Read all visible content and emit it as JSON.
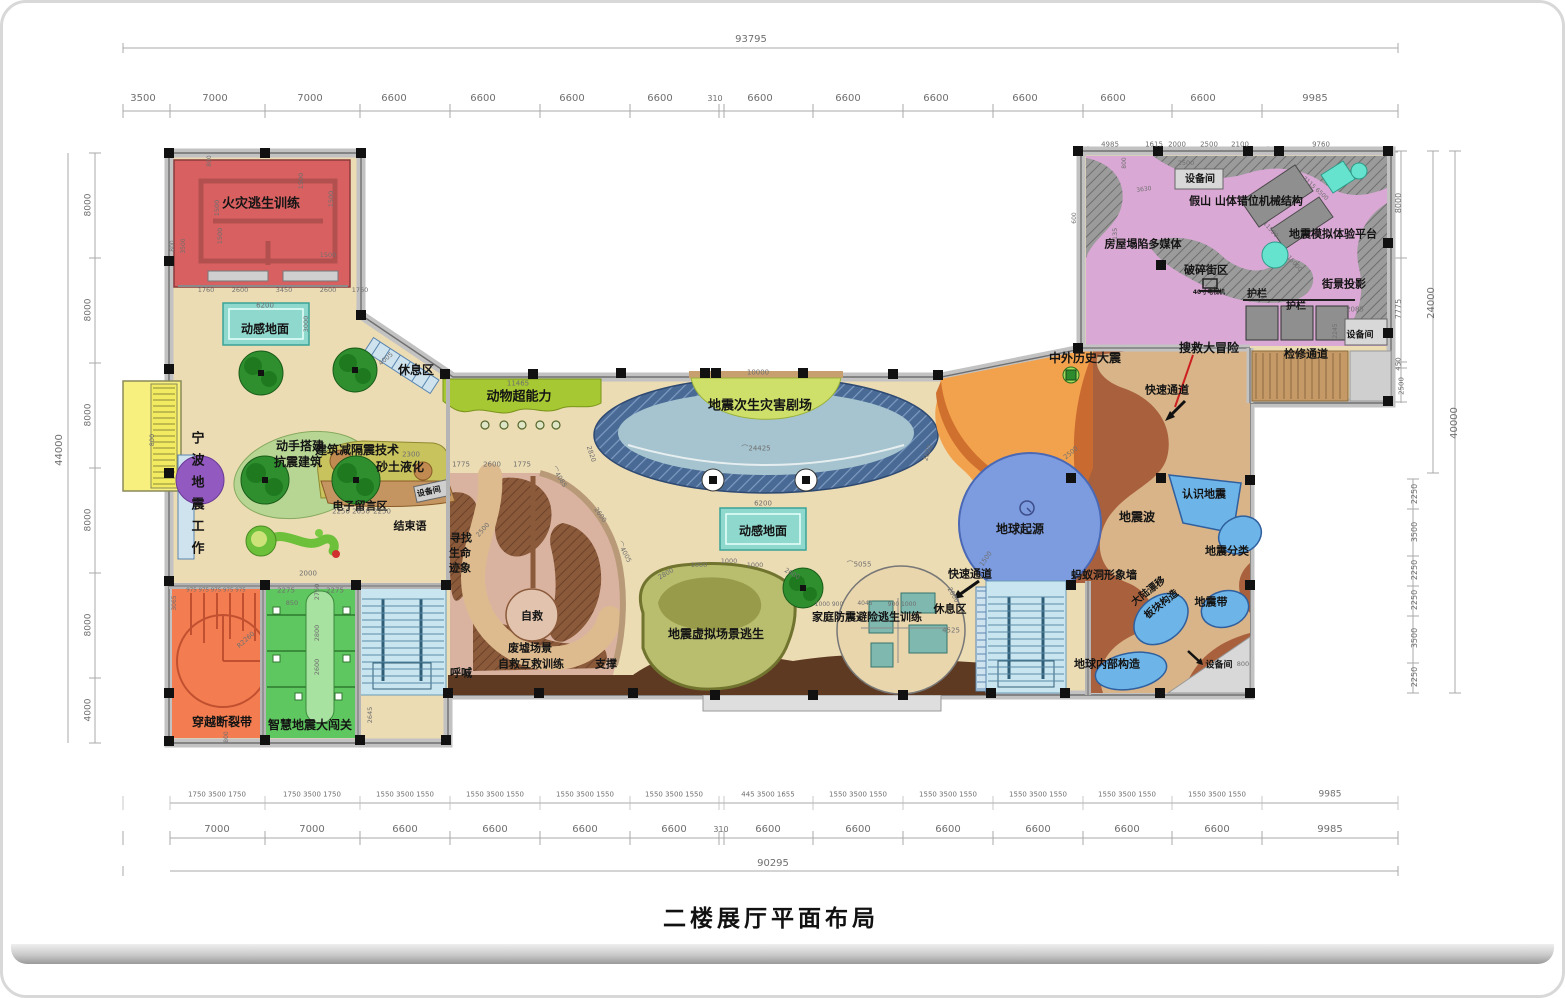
{
  "title": "二楼展厅平面布局",
  "palette": {
    "floor": "#ecdcb4",
    "wall": "#c2c2c2",
    "fire_room": "#d96060",
    "mat_teal": "#8fd8ce",
    "animal_band": "#a6c832",
    "theater_navy": "#4a6a96",
    "theater_inner": "#a5c4cf",
    "stage": "#cfe06a",
    "orange": "#f2a24d",
    "orange_dark": "#d0702e",
    "brown": "#a9603c",
    "path_tan": "#d8b488",
    "pink": "#d9a8d4",
    "rockery": "#9b9b9b",
    "cyan_slide": "#66e3cf",
    "earth_blue": "#7d9ce0",
    "stairs_blue": "#c9e6f0",
    "ruins_dark": "#8a5a3a",
    "ruins_light": "#d9b3a0",
    "olive": "#b9bd6e",
    "family_tan": "#e9d6ad",
    "room_orange": "#f37c50",
    "room_green": "#5fc75f",
    "yellow": "#f7f07e",
    "purple": "#9259c0",
    "tree_green": "#2f8f2f",
    "teal_room": "#7fb8af",
    "blue_blob": "#6db5e8",
    "dark_band": "#5f3a22",
    "dim_text": "#6f6f6f"
  },
  "zones": [
    {
      "t": "火灾逃生训练",
      "x": 258,
      "y": 201,
      "s": 13,
      "n": "zone-fire-escape-training"
    },
    {
      "t": "动感地面",
      "x": 262,
      "y": 326,
      "s": 12,
      "n": "zone-dynamic-floor-1"
    },
    {
      "t": "休息区",
      "x": 413,
      "y": 367,
      "s": 12,
      "n": "zone-rest-area-1"
    },
    {
      "t": "动物超能力",
      "x": 516,
      "y": 394,
      "s": 13,
      "n": "zone-animal-superpower"
    },
    {
      "t": "宁波地震工作",
      "x": 193,
      "y": 494,
      "s": 13,
      "v": 1,
      "n": "zone-ningbo-seismic-work"
    },
    {
      "t": "动手搭建",
      "x": 297,
      "y": 443,
      "s": 12,
      "n": "zone-build-quake-resistant-1"
    },
    {
      "t": "抗震建筑",
      "x": 295,
      "y": 459,
      "s": 12,
      "n": "zone-build-quake-resistant-2"
    },
    {
      "t": "建筑减隔震技术",
      "x": 354,
      "y": 447,
      "s": 12,
      "n": "zone-seismic-isolation-tech"
    },
    {
      "t": "砂土液化",
      "x": 397,
      "y": 464,
      "s": 12,
      "n": "zone-sand-liquefaction"
    },
    {
      "t": "电子留言区",
      "x": 357,
      "y": 503,
      "s": 11,
      "n": "zone-e-message-area"
    },
    {
      "t": "设备间",
      "x": 426,
      "y": 489,
      "s": 8,
      "r": -12,
      "n": "zone-equipment-room-1"
    },
    {
      "t": "结束语",
      "x": 407,
      "y": 523,
      "s": 11,
      "n": "zone-epilogue"
    },
    {
      "t": "地震次生灾害剧场",
      "x": 757,
      "y": 403,
      "s": 13,
      "n": "zone-secondary-disaster-theater"
    },
    {
      "t": "动感地面",
      "x": 760,
      "y": 528,
      "s": 12,
      "n": "zone-dynamic-floor-2"
    },
    {
      "t": "中外历史大震",
      "x": 1082,
      "y": 355,
      "s": 12,
      "n": "zone-historic-earthquakes"
    },
    {
      "t": "搜救大冒险",
      "x": 1206,
      "y": 345,
      "s": 12,
      "n": "zone-search-rescue-adventure"
    },
    {
      "t": "快速通道",
      "x": 1164,
      "y": 387,
      "s": 11,
      "n": "zone-fast-lane-1"
    },
    {
      "t": "破碎街区",
      "x": 1203,
      "y": 267,
      "s": 11,
      "n": "zone-broken-street"
    },
    {
      "t": "40寸电视机",
      "x": 1206,
      "y": 290,
      "s": 6,
      "n": "label-40in-tv"
    },
    {
      "t": "护栏",
      "x": 1254,
      "y": 292,
      "s": 10,
      "n": "label-guardrail-1"
    },
    {
      "t": "护栏",
      "x": 1293,
      "y": 304,
      "s": 10,
      "n": "label-guardrail-2"
    },
    {
      "t": "街景投影",
      "x": 1341,
      "y": 281,
      "s": 11,
      "n": "zone-streetview-projection"
    },
    {
      "t": "设备间",
      "x": 1357,
      "y": 333,
      "s": 9,
      "n": "zone-equipment-room-2"
    },
    {
      "t": "检修通道",
      "x": 1303,
      "y": 351,
      "s": 11,
      "n": "zone-maintenance-passage"
    },
    {
      "t": "设备间",
      "x": 1197,
      "y": 177,
      "s": 10,
      "n": "zone-equipment-room-3"
    },
    {
      "t": "假山 山体错位机械结构",
      "x": 1243,
      "y": 198,
      "s": 11,
      "n": "zone-rockery-mechanism"
    },
    {
      "t": "房屋塌陷多媒体",
      "x": 1140,
      "y": 241,
      "s": 11,
      "n": "zone-house-collapse-multimedia"
    },
    {
      "t": "地震模拟体验平台",
      "x": 1330,
      "y": 231,
      "s": 11,
      "n": "zone-quake-simulation-platform"
    },
    {
      "t": "地球起源",
      "x": 1017,
      "y": 526,
      "s": 12,
      "n": "zone-earth-origin"
    },
    {
      "t": "快速通道",
      "x": 967,
      "y": 571,
      "s": 11,
      "n": "zone-fast-lane-2"
    },
    {
      "t": "休息区",
      "x": 947,
      "y": 606,
      "s": 11,
      "n": "zone-rest-area-2"
    },
    {
      "t": "蚂蚁洞形象墙",
      "x": 1101,
      "y": 572,
      "s": 11,
      "n": "zone-ant-hole-wall"
    },
    {
      "t": "大陆漂移",
      "x": 1146,
      "y": 589,
      "s": 10,
      "r": -38,
      "n": "zone-continental-drift"
    },
    {
      "t": "板块构造",
      "x": 1159,
      "y": 602,
      "s": 10,
      "r": -38,
      "n": "zone-plate-tectonics"
    },
    {
      "t": "地震波",
      "x": 1134,
      "y": 514,
      "s": 12,
      "n": "zone-seismic-waves"
    },
    {
      "t": "认识地震",
      "x": 1201,
      "y": 491,
      "s": 11,
      "n": "zone-know-earthquakes"
    },
    {
      "t": "地震分类",
      "x": 1224,
      "y": 548,
      "s": 11,
      "n": "zone-quake-classification"
    },
    {
      "t": "地震带",
      "x": 1208,
      "y": 599,
      "s": 11,
      "n": "zone-seismic-belts"
    },
    {
      "t": "地球内部构造",
      "x": 1104,
      "y": 661,
      "s": 11,
      "n": "zone-earth-interior"
    },
    {
      "t": "设备间",
      "x": 1216,
      "y": 663,
      "s": 9,
      "n": "zone-equipment-room-4"
    },
    {
      "t": "家庭防震避险逃生训练",
      "x": 864,
      "y": 614,
      "s": 11,
      "n": "zone-family-escape-training"
    },
    {
      "t": "地震虚拟场景逃生",
      "x": 713,
      "y": 631,
      "s": 12,
      "n": "zone-virtual-scene-escape"
    },
    {
      "t": "寻找",
      "x": 458,
      "y": 535,
      "s": 11,
      "n": "zone-find-life-signs-1"
    },
    {
      "t": "生命",
      "x": 457,
      "y": 550,
      "s": 11,
      "n": "zone-find-life-signs-2"
    },
    {
      "t": "迹象",
      "x": 457,
      "y": 565,
      "s": 11,
      "n": "zone-find-life-signs-3"
    },
    {
      "t": "自救",
      "x": 529,
      "y": 613,
      "s": 11,
      "n": "zone-self-rescue"
    },
    {
      "t": "废墟场景",
      "x": 527,
      "y": 645,
      "s": 11,
      "n": "zone-ruins-scene"
    },
    {
      "t": "自救互救训练",
      "x": 528,
      "y": 661,
      "s": 11,
      "n": "zone-mutual-rescue-training"
    },
    {
      "t": "呼喊",
      "x": 458,
      "y": 670,
      "s": 11,
      "n": "zone-shouting"
    },
    {
      "t": "支撑",
      "x": 603,
      "y": 661,
      "s": 11,
      "n": "zone-support"
    },
    {
      "t": "穿越断裂带",
      "x": 219,
      "y": 719,
      "s": 12,
      "n": "zone-cross-fault"
    },
    {
      "t": "智慧地震大闯关",
      "x": 307,
      "y": 722,
      "s": 12,
      "n": "zone-smart-quake-challenge"
    }
  ],
  "dims": [
    {
      "t": "93795",
      "x": 748,
      "y": 37,
      "s": 10
    },
    {
      "t": "3500",
      "x": 140,
      "y": 96,
      "s": 10
    },
    {
      "t": "7000",
      "x": 212,
      "y": 96,
      "s": 10
    },
    {
      "t": "7000",
      "x": 307,
      "y": 96,
      "s": 10
    },
    {
      "t": "6600",
      "x": 391,
      "y": 96,
      "s": 10
    },
    {
      "t": "6600",
      "x": 480,
      "y": 96,
      "s": 10
    },
    {
      "t": "6600",
      "x": 569,
      "y": 96,
      "s": 10
    },
    {
      "t": "6600",
      "x": 657,
      "y": 96,
      "s": 10
    },
    {
      "t": "310",
      "x": 712,
      "y": 96,
      "s": 8
    },
    {
      "t": "6600",
      "x": 757,
      "y": 96,
      "s": 10
    },
    {
      "t": "6600",
      "x": 845,
      "y": 96,
      "s": 10
    },
    {
      "t": "6600",
      "x": 933,
      "y": 96,
      "s": 10
    },
    {
      "t": "6600",
      "x": 1022,
      "y": 96,
      "s": 10
    },
    {
      "t": "6600",
      "x": 1110,
      "y": 96,
      "s": 10
    },
    {
      "t": "6600",
      "x": 1200,
      "y": 96,
      "s": 10
    },
    {
      "t": "9985",
      "x": 1312,
      "y": 96,
      "s": 10
    },
    {
      "t": "4985",
      "x": 1107,
      "y": 142,
      "s": 7
    },
    {
      "t": "1615",
      "x": 1151,
      "y": 142,
      "s": 7
    },
    {
      "t": "2000",
      "x": 1174,
      "y": 142,
      "s": 7
    },
    {
      "t": "2500",
      "x": 1206,
      "y": 142,
      "s": 7
    },
    {
      "t": "2100",
      "x": 1237,
      "y": 142,
      "s": 7
    },
    {
      "t": "9760",
      "x": 1318,
      "y": 142,
      "s": 7
    },
    {
      "t": "1750 3500 1750",
      "x": 214,
      "y": 792,
      "s": 7
    },
    {
      "t": "1750 3500 1750",
      "x": 309,
      "y": 792,
      "s": 7
    },
    {
      "t": "1550 3500 1550",
      "x": 402,
      "y": 792,
      "s": 7
    },
    {
      "t": "1550 3500 1550",
      "x": 492,
      "y": 792,
      "s": 7
    },
    {
      "t": "1550 3500 1550",
      "x": 582,
      "y": 792,
      "s": 7
    },
    {
      "t": "1550 3500 1550",
      "x": 671,
      "y": 792,
      "s": 7
    },
    {
      "t": "445 3500 1655",
      "x": 765,
      "y": 792,
      "s": 7
    },
    {
      "t": "1550 3500 1550",
      "x": 855,
      "y": 792,
      "s": 7
    },
    {
      "t": "1550 3500 1550",
      "x": 945,
      "y": 792,
      "s": 7
    },
    {
      "t": "1550 3500 1550",
      "x": 1035,
      "y": 792,
      "s": 7
    },
    {
      "t": "1550 3500 1550",
      "x": 1124,
      "y": 792,
      "s": 7
    },
    {
      "t": "1550 3500 1550",
      "x": 1214,
      "y": 792,
      "s": 7
    },
    {
      "t": "9985",
      "x": 1327,
      "y": 792,
      "s": 9
    },
    {
      "t": "7000",
      "x": 214,
      "y": 827,
      "s": 10
    },
    {
      "t": "7000",
      "x": 309,
      "y": 827,
      "s": 10
    },
    {
      "t": "6600",
      "x": 402,
      "y": 827,
      "s": 10
    },
    {
      "t": "6600",
      "x": 492,
      "y": 827,
      "s": 10
    },
    {
      "t": "6600",
      "x": 582,
      "y": 827,
      "s": 10
    },
    {
      "t": "6600",
      "x": 671,
      "y": 827,
      "s": 10
    },
    {
      "t": "310",
      "x": 718,
      "y": 827,
      "s": 8
    },
    {
      "t": "6600",
      "x": 765,
      "y": 827,
      "s": 10
    },
    {
      "t": "6600",
      "x": 855,
      "y": 827,
      "s": 10
    },
    {
      "t": "6600",
      "x": 945,
      "y": 827,
      "s": 10
    },
    {
      "t": "6600",
      "x": 1035,
      "y": 827,
      "s": 10
    },
    {
      "t": "6600",
      "x": 1124,
      "y": 827,
      "s": 10
    },
    {
      "t": "6600",
      "x": 1214,
      "y": 827,
      "s": 10
    },
    {
      "t": "9985",
      "x": 1327,
      "y": 827,
      "s": 10
    },
    {
      "t": "90295",
      "x": 770,
      "y": 861,
      "s": 10
    },
    {
      "t": "44000",
      "x": 57,
      "y": 447,
      "s": 10,
      "r": -90
    },
    {
      "t": "8000",
      "x": 86,
      "y": 202,
      "s": 9,
      "r": -90
    },
    {
      "t": "8000",
      "x": 86,
      "y": 307,
      "s": 9,
      "r": -90
    },
    {
      "t": "8000",
      "x": 86,
      "y": 412,
      "s": 9,
      "r": -90
    },
    {
      "t": "8000",
      "x": 86,
      "y": 517,
      "s": 9,
      "r": -90
    },
    {
      "t": "8000",
      "x": 86,
      "y": 622,
      "s": 9,
      "r": -90
    },
    {
      "t": "4000",
      "x": 86,
      "y": 707,
      "s": 9,
      "r": -90
    },
    {
      "t": "8000",
      "x": 1396,
      "y": 200,
      "s": 8,
      "r": -90
    },
    {
      "t": "7775",
      "x": 1396,
      "y": 306,
      "s": 8,
      "r": -90
    },
    {
      "t": "450",
      "x": 1396,
      "y": 361,
      "s": 7,
      "r": -90
    },
    {
      "t": "2500",
      "x": 1399,
      "y": 383,
      "s": 7,
      "r": -90
    },
    {
      "t": "24000",
      "x": 1429,
      "y": 300,
      "s": 10,
      "r": -90
    },
    {
      "t": "40000",
      "x": 1452,
      "y": 420,
      "s": 10,
      "r": -90
    },
    {
      "t": "2250",
      "x": 1412,
      "y": 491,
      "s": 8,
      "r": -90
    },
    {
      "t": "3500",
      "x": 1412,
      "y": 529,
      "s": 8,
      "r": -90
    },
    {
      "t": "2250",
      "x": 1412,
      "y": 567,
      "s": 8,
      "r": -90
    },
    {
      "t": "2250",
      "x": 1412,
      "y": 597,
      "s": 8,
      "r": -90
    },
    {
      "t": "3500",
      "x": 1412,
      "y": 635,
      "s": 8,
      "r": -90
    },
    {
      "t": "2250",
      "x": 1412,
      "y": 674,
      "s": 8,
      "r": -90
    },
    {
      "t": "1760",
      "x": 203,
      "y": 287,
      "s": 6.5
    },
    {
      "t": "2600",
      "x": 237,
      "y": 287,
      "s": 6.5
    },
    {
      "t": "3450",
      "x": 281,
      "y": 287,
      "s": 6.5
    },
    {
      "t": "2600",
      "x": 325,
      "y": 287,
      "s": 6.5
    },
    {
      "t": "1760",
      "x": 357,
      "y": 287,
      "s": 6.5
    },
    {
      "t": "6200",
      "x": 262,
      "y": 303,
      "s": 7
    },
    {
      "t": "3000",
      "x": 303,
      "y": 321,
      "s": 6.5,
      "r": -90
    },
    {
      "t": "1500",
      "x": 298,
      "y": 178,
      "s": 6.5,
      "r": -90
    },
    {
      "t": "1500",
      "x": 328,
      "y": 196,
      "s": 6.5,
      "r": -90
    },
    {
      "t": "1500",
      "x": 214,
      "y": 205,
      "s": 6.5,
      "r": -90
    },
    {
      "t": "1500",
      "x": 217,
      "y": 233,
      "s": 6.5,
      "r": -90
    },
    {
      "t": "1500",
      "x": 325,
      "y": 252,
      "s": 6.5
    },
    {
      "t": "800",
      "x": 170,
      "y": 243,
      "s": 6,
      "r": -90
    },
    {
      "t": "3500",
      "x": 181,
      "y": 243,
      "s": 6,
      "r": -90
    },
    {
      "t": "800",
      "x": 207,
      "y": 158,
      "s": 6,
      "r": -90
    },
    {
      "t": "800",
      "x": 149,
      "y": 437,
      "s": 6.5,
      "r": -90
    },
    {
      "t": "11465",
      "x": 515,
      "y": 381,
      "s": 7
    },
    {
      "t": "1775",
      "x": 458,
      "y": 462,
      "s": 7
    },
    {
      "t": "2600",
      "x": 489,
      "y": 462,
      "s": 7
    },
    {
      "t": "1775",
      "x": 519,
      "y": 462,
      "s": 7
    },
    {
      "t": "2300",
      "x": 408,
      "y": 452,
      "s": 7
    },
    {
      "t": "2250",
      "x": 338,
      "y": 509,
      "s": 7
    },
    {
      "t": "2650",
      "x": 358,
      "y": 509,
      "s": 7
    },
    {
      "t": "2250",
      "x": 379,
      "y": 509,
      "s": 7
    },
    {
      "t": "4005",
      "x": 383,
      "y": 356,
      "s": 6.5,
      "r": -40
    },
    {
      "t": "10000",
      "x": 755,
      "y": 370,
      "s": 7
    },
    {
      "t": "⌒24425",
      "x": 753,
      "y": 446,
      "s": 7
    },
    {
      "t": "2820",
      "x": 588,
      "y": 451,
      "s": 6.5,
      "r": 72
    },
    {
      "t": "2620",
      "x": 925,
      "y": 450,
      "s": 6.5,
      "r": -72
    },
    {
      "t": "⌒4085",
      "x": 556,
      "y": 474,
      "s": 6.5,
      "r": 58
    },
    {
      "t": "2600",
      "x": 597,
      "y": 512,
      "s": 6.5,
      "r": 55
    },
    {
      "t": "⌒4005",
      "x": 621,
      "y": 549,
      "s": 6.5,
      "r": 62
    },
    {
      "t": "2500",
      "x": 480,
      "y": 527,
      "s": 6.5,
      "r": -48
    },
    {
      "t": "6200",
      "x": 760,
      "y": 501,
      "s": 7
    },
    {
      "t": "2800",
      "x": 663,
      "y": 571,
      "s": 6.5,
      "r": -30
    },
    {
      "t": "1000",
      "x": 696,
      "y": 562,
      "s": 6.5
    },
    {
      "t": "1000",
      "x": 726,
      "y": 558,
      "s": 6.5
    },
    {
      "t": "1000",
      "x": 752,
      "y": 562,
      "s": 6.5
    },
    {
      "t": "2600",
      "x": 789,
      "y": 571,
      "s": 6.5,
      "r": 30
    },
    {
      "t": "⌒5055",
      "x": 856,
      "y": 562,
      "s": 7
    },
    {
      "t": "2600",
      "x": 950,
      "y": 592,
      "s": 6.5,
      "r": 60
    },
    {
      "t": "1000 900",
      "x": 826,
      "y": 602,
      "s": 6
    },
    {
      "t": "4045",
      "x": 862,
      "y": 601,
      "s": 6
    },
    {
      "t": "900 1000",
      "x": 899,
      "y": 602,
      "s": 6
    },
    {
      "t": "4525",
      "x": 948,
      "y": 628,
      "s": 7
    },
    {
      "t": "1500",
      "x": 983,
      "y": 556,
      "s": 6.5,
      "r": -55
    },
    {
      "t": "2500",
      "x": 1068,
      "y": 450,
      "s": 6.5,
      "r": -40
    },
    {
      "t": "2000",
      "x": 305,
      "y": 571,
      "s": 7
    },
    {
      "t": "2275",
      "x": 283,
      "y": 588,
      "s": 7
    },
    {
      "t": "850",
      "x": 289,
      "y": 600,
      "s": 6.5
    },
    {
      "t": "2275",
      "x": 332,
      "y": 588,
      "s": 7
    },
    {
      "t": "2760",
      "x": 314,
      "y": 589,
      "s": 6.5,
      "r": -90
    },
    {
      "t": "2800",
      "x": 314,
      "y": 630,
      "s": 6.5,
      "r": -90
    },
    {
      "t": "2600",
      "x": 314,
      "y": 664,
      "s": 6.5,
      "r": -90
    },
    {
      "t": "2645",
      "x": 367,
      "y": 712,
      "s": 6.5,
      "r": -90
    },
    {
      "t": "975 975 975 975 975",
      "x": 213,
      "y": 588,
      "s": 5.5
    },
    {
      "t": "3065",
      "x": 172,
      "y": 600,
      "s": 6,
      "r": -90
    },
    {
      "t": "R2260",
      "x": 243,
      "y": 637,
      "s": 6.5,
      "r": -42
    },
    {
      "t": "800",
      "x": 224,
      "y": 734,
      "s": 6,
      "r": -90
    },
    {
      "t": "2500",
      "x": 1183,
      "y": 160,
      "s": 6.5
    },
    {
      "t": "3630",
      "x": 1141,
      "y": 187,
      "s": 6,
      "r": -8
    },
    {
      "t": "5135",
      "x": 1112,
      "y": 233,
      "s": 6.5,
      "r": -90
    },
    {
      "t": "800",
      "x": 1122,
      "y": 160,
      "s": 6,
      "r": -90
    },
    {
      "t": "600",
      "x": 1072,
      "y": 215,
      "s": 6,
      "r": -90
    },
    {
      "t": "7115 6500",
      "x": 1312,
      "y": 186,
      "s": 6,
      "r": 42
    },
    {
      "t": "11500",
      "x": 1267,
      "y": 227,
      "s": 6,
      "r": 48
    },
    {
      "t": "15000",
      "x": 1291,
      "y": 261,
      "s": 6,
      "r": 48
    },
    {
      "t": "2085",
      "x": 1352,
      "y": 307,
      "s": 7
    },
    {
      "t": "2245",
      "x": 1333,
      "y": 328,
      "s": 6,
      "r": -90
    },
    {
      "t": "800",
      "x": 1240,
      "y": 661,
      "s": 6.5
    }
  ]
}
